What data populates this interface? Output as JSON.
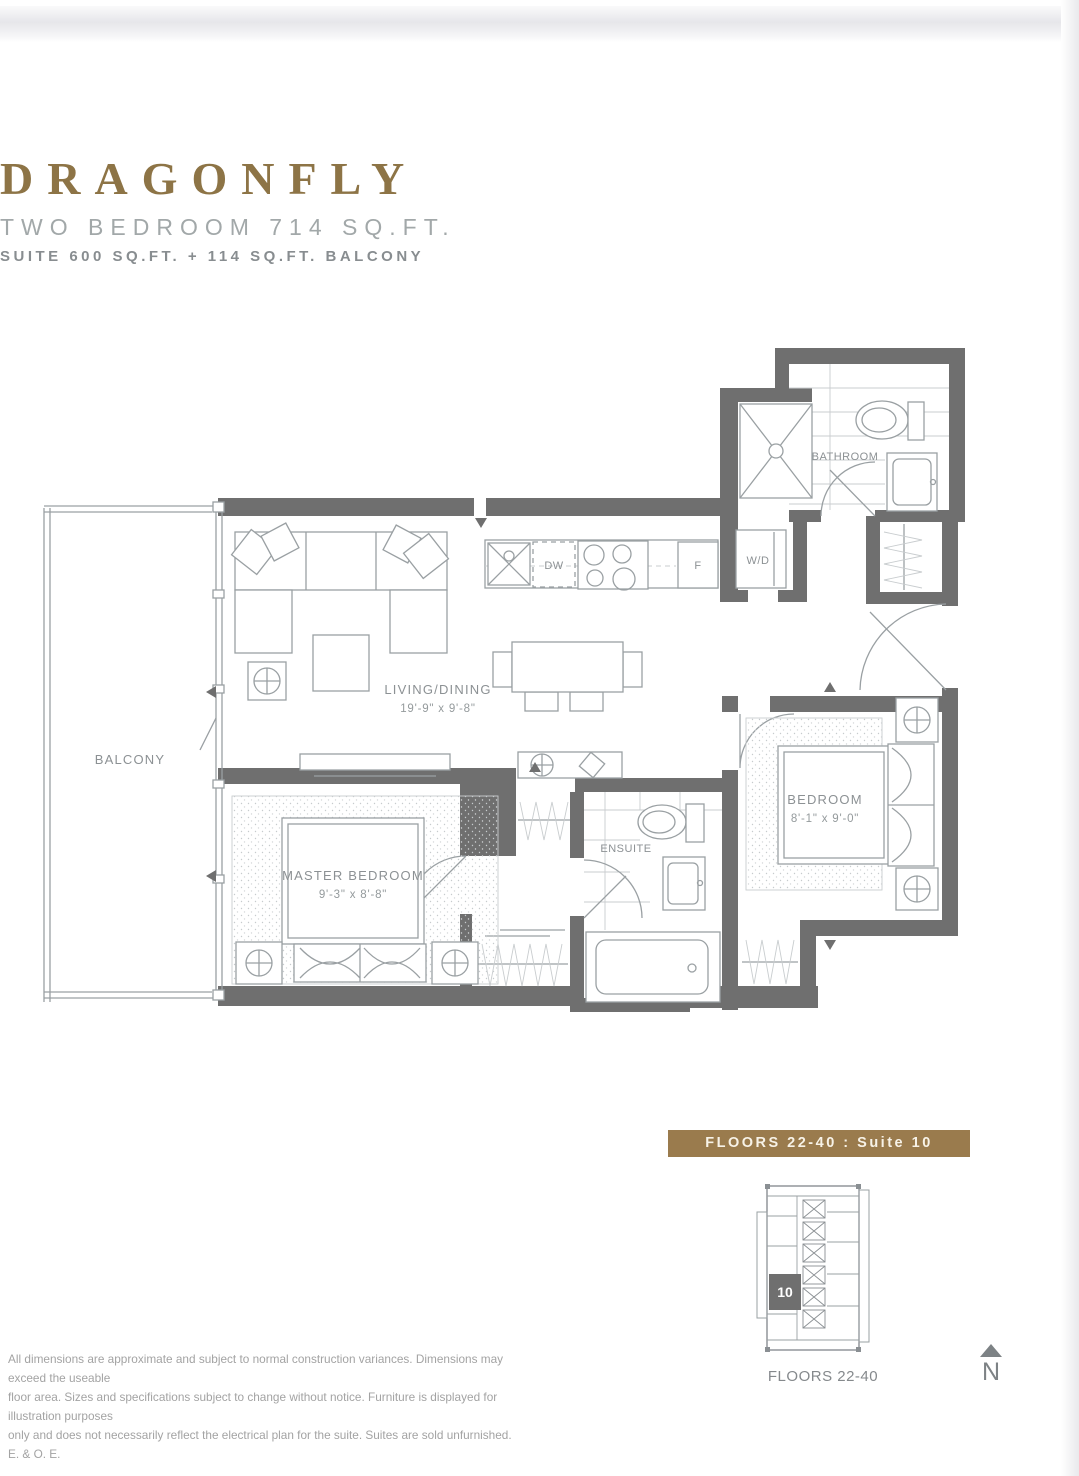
{
  "header": {
    "title": "DRAGONFLY",
    "subtitle": "TWO BEDROOM 714 SQ.FT.",
    "suite_info": "SUITE 600 SQ.FT. + 114 SQ.FT. BALCONY"
  },
  "plan": {
    "balcony": "BALCONY",
    "living_dining": {
      "name": "LIVING/DINING",
      "dims": "19'-9\" x 9'-8\""
    },
    "master_bedroom": {
      "name": "MASTER BEDROOM",
      "dims": "9'-3\" x 8'-8\""
    },
    "bedroom": {
      "name": "BEDROOM",
      "dims": "8'-1\" x 9'-0\""
    },
    "ensuite": "ENSUITE",
    "bathroom": "BATHROOM",
    "washer_dryer": "W/D",
    "dishwasher": "DW",
    "fridge": "F"
  },
  "keyplan": {
    "banner": "FLOORS 22-40 : Suite 10",
    "suite_number": "10",
    "caption": "FLOORS 22-40",
    "north_label": "N"
  },
  "disclaimer": {
    "line1": "All dimensions are approximate and subject to normal construction variances. Dimensions may exceed the useable",
    "line2": "floor area. Sizes and specifications subject to change without notice. Furniture is displayed for illustration purposes",
    "line3": "only and does not necessarily reflect the electrical plan for the suite. Suites are sold unfurnished. E. & O. E."
  },
  "colors": {
    "title_gold": "#8d7446",
    "banner_gold": "#9a7b4d",
    "wall_gray": "#6f6f6f",
    "line_gray": "#9aa0a3"
  }
}
